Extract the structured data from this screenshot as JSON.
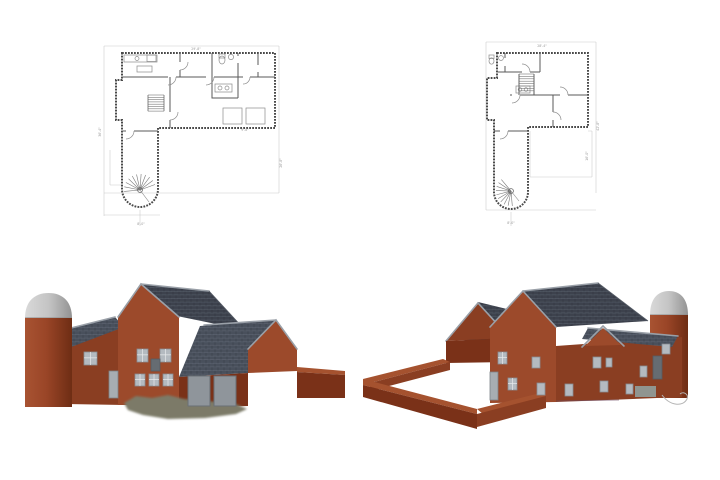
{
  "sheet": {
    "background": "#ffffff",
    "description_labels": {}
  },
  "colors": {
    "bg": "#ffffff",
    "line_light": "#cccccc",
    "line_wall": "#4a4a4a",
    "line_interior": "#5a5a5a",
    "line_fixture": "#8a8a8a",
    "dim_text": "#9a9a9a",
    "brick_lit": "#9c4a2b",
    "brick_mid": "#8a3e22",
    "brick_dark": "#7a3118",
    "brick_top": "#a5522f",
    "roof_dark": "#3d424d",
    "roof_mid": "#49505c",
    "ridge_cap": "#9aa0a8",
    "eave_edge": "#565c66",
    "silo_light": "#a85332",
    "silo_mid": "#9a4527",
    "silo_dark": "#6e2d14",
    "dome_light": "#d9d9d9",
    "dome_mid": "#c4c4c4",
    "dome_dark": "#939393",
    "dome_rim": "#8a8a8a",
    "window_fill": "#b4bac0",
    "window_frame": "#878d93",
    "window_dark": "#666c72",
    "door_fill": "#a7adb2",
    "door_frame": "#7d8388",
    "garage_fill": "#8f959b",
    "garage_frame": "#6a7076",
    "stoop": "#909590",
    "ground": "#7b7a68",
    "curve": "#b5b5b5",
    "base_line": "#6e4b63"
  },
  "floorplan_left": {
    "name": "first-floor-plan",
    "dim_labels": [
      {
        "x": 196,
        "y": 50,
        "r": 0,
        "t": "29'-8\""
      },
      {
        "x": 101,
        "y": 132,
        "r": -90,
        "t": "36'-4\""
      },
      {
        "x": 282,
        "y": 163,
        "r": -90,
        "t": "26'-8\""
      },
      {
        "x": 141,
        "y": 225,
        "r": 0,
        "t": "8'-0\""
      },
      {
        "x": 245,
        "y": 131,
        "r": 0,
        "t": "9'-8\""
      }
    ],
    "stairs": {
      "x1": 148,
      "x2": 164,
      "y": 95,
      "count": 8,
      "step": 2.3
    },
    "spiral": {
      "cx": 140,
      "cy": 190,
      "r": 16,
      "a0": -185,
      "a1": -20,
      "count": 11,
      "tailx": 149,
      "taily": 202
    }
  },
  "floorplan_right": {
    "name": "second-floor-plan",
    "dim_labels": [
      {
        "x": 542,
        "y": 47,
        "r": 0,
        "t": "28'-4\""
      },
      {
        "x": 599,
        "y": 126,
        "r": -90,
        "t": "42'-8\""
      },
      {
        "x": 588,
        "y": 156,
        "r": -90,
        "t": "16'-0\""
      },
      {
        "x": 511,
        "y": 224,
        "r": 0,
        "t": "8'-0\""
      }
    ],
    "stairs": {
      "x1": 519,
      "x2": 534,
      "y": 74,
      "count": 8,
      "step": 2.4
    },
    "spiral": {
      "cx": 511,
      "cy": 191,
      "r": 15,
      "a0": 85,
      "a1": 230,
      "count": 10,
      "tailx": 519,
      "taily": 201
    }
  },
  "render_left": {
    "name": "perspective-front-left",
    "openings": [
      {
        "t": "win",
        "x": 84,
        "y": 352,
        "w": 13,
        "h": 13
      },
      {
        "t": "door",
        "x": 109,
        "y": 371,
        "w": 9,
        "h": 27
      },
      {
        "t": "win",
        "x": 137,
        "y": 349,
        "w": 11,
        "h": 13
      },
      {
        "t": "win",
        "x": 160,
        "y": 349,
        "w": 11,
        "h": 13
      },
      {
        "t": "windark",
        "x": 151,
        "y": 359,
        "w": 9,
        "h": 12
      },
      {
        "t": "win",
        "x": 135,
        "y": 374,
        "w": 10,
        "h": 12
      },
      {
        "t": "win",
        "x": 149,
        "y": 374,
        "w": 10,
        "h": 12
      },
      {
        "t": "win",
        "x": 163,
        "y": 374,
        "w": 10,
        "h": 12
      },
      {
        "t": "garage",
        "x": 188,
        "y": 376,
        "w": 22,
        "h": 30
      },
      {
        "t": "garage",
        "x": 214,
        "y": 376,
        "w": 22,
        "h": 30
      }
    ]
  },
  "render_right": {
    "name": "perspective-back-right",
    "openings": [
      {
        "t": "win",
        "x": 498,
        "y": 352,
        "w": 9,
        "h": 12
      },
      {
        "t": "win",
        "x": 532,
        "y": 357,
        "w": 8,
        "h": 11
      },
      {
        "t": "door",
        "x": 490,
        "y": 372,
        "w": 8,
        "h": 28
      },
      {
        "t": "win",
        "x": 508,
        "y": 378,
        "w": 9,
        "h": 12
      },
      {
        "t": "win",
        "x": 537,
        "y": 383,
        "w": 8,
        "h": 12
      },
      {
        "t": "win",
        "x": 565,
        "y": 384,
        "w": 8,
        "h": 12
      },
      {
        "t": "win",
        "x": 593,
        "y": 357,
        "w": 8,
        "h": 11
      },
      {
        "t": "win",
        "x": 606,
        "y": 358,
        "w": 6,
        "h": 9
      },
      {
        "t": "win",
        "x": 600,
        "y": 381,
        "w": 8,
        "h": 11
      },
      {
        "t": "win",
        "x": 626,
        "y": 384,
        "w": 7,
        "h": 10
      },
      {
        "t": "win",
        "x": 640,
        "y": 366,
        "w": 7,
        "h": 11
      },
      {
        "t": "windark",
        "x": 653,
        "y": 356,
        "w": 9,
        "h": 23
      },
      {
        "t": "win",
        "x": 662,
        "y": 344,
        "w": 8,
        "h": 10
      },
      {
        "t": "stoop",
        "x": 635,
        "y": 386,
        "w": 21,
        "h": 11
      }
    ]
  }
}
